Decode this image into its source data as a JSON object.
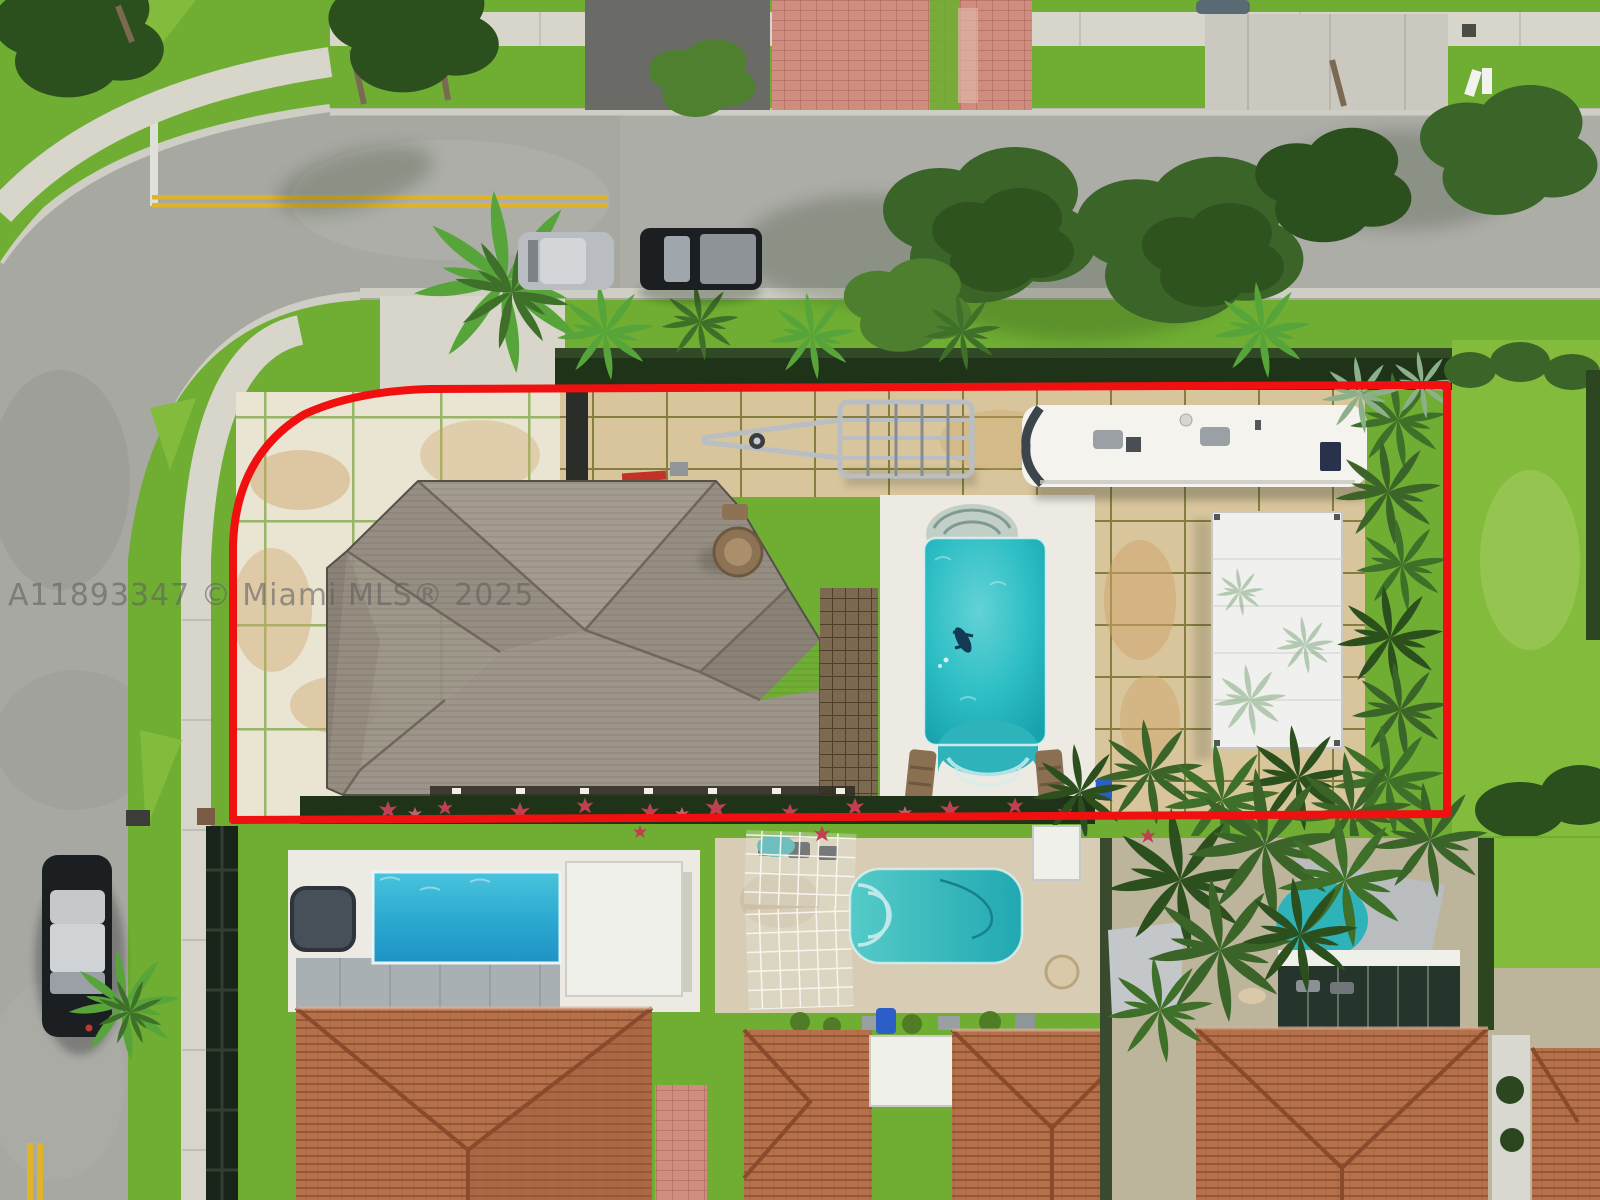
{
  "watermark": {
    "text": "A11893347 © Miami MLS® 2025"
  },
  "colors": {
    "boundary": "#f01010",
    "watermark": "#5f5f5f",
    "street": "#a7a8a2",
    "asph": "#6a6b66",
    "conc": "#cbc9bf",
    "sidewalk": "#d8d6ca",
    "gutter": "#cfcec4",
    "grass": "#6fae33",
    "grassB": "#83bb3c",
    "grassD": "#4e7d26",
    "tree": "#3a6428",
    "treeD": "#2c501d",
    "palm": "#57a53a",
    "palmD": "#3e7029",
    "palmSilver": "#8cb08a",
    "hedge": "#2c471f",
    "wall": "#1f3318",
    "slab": "#eae4d2",
    "tan": "#d8c59c",
    "sun": "#cfa368",
    "deck": "#eceae2",
    "white": "#f0f0ea",
    "rv": "#f4f3ee",
    "canopy": "#f0f1ee",
    "roofA": "#a49c90",
    "roofB": "#968e82",
    "roofC": "#8a8276",
    "roofD": "#9d958a",
    "ridge": "#6f675c",
    "terra": "#b4714b",
    "terraD": "#9a5a3a",
    "pink": "#cf8d80",
    "metal": "#b9bec4",
    "pool": "#2ebfc5",
    "pool2": "#2fb3ba",
    "pooln1a": "#41c0dc",
    "pooln1b": "#1e93c4",
    "carBlack": "#1c1f22",
    "carSilver": "#b9bdc1",
    "yellow": "#e0b428",
    "flower": "#c04052",
    "blue": "#2b5fc7"
  }
}
